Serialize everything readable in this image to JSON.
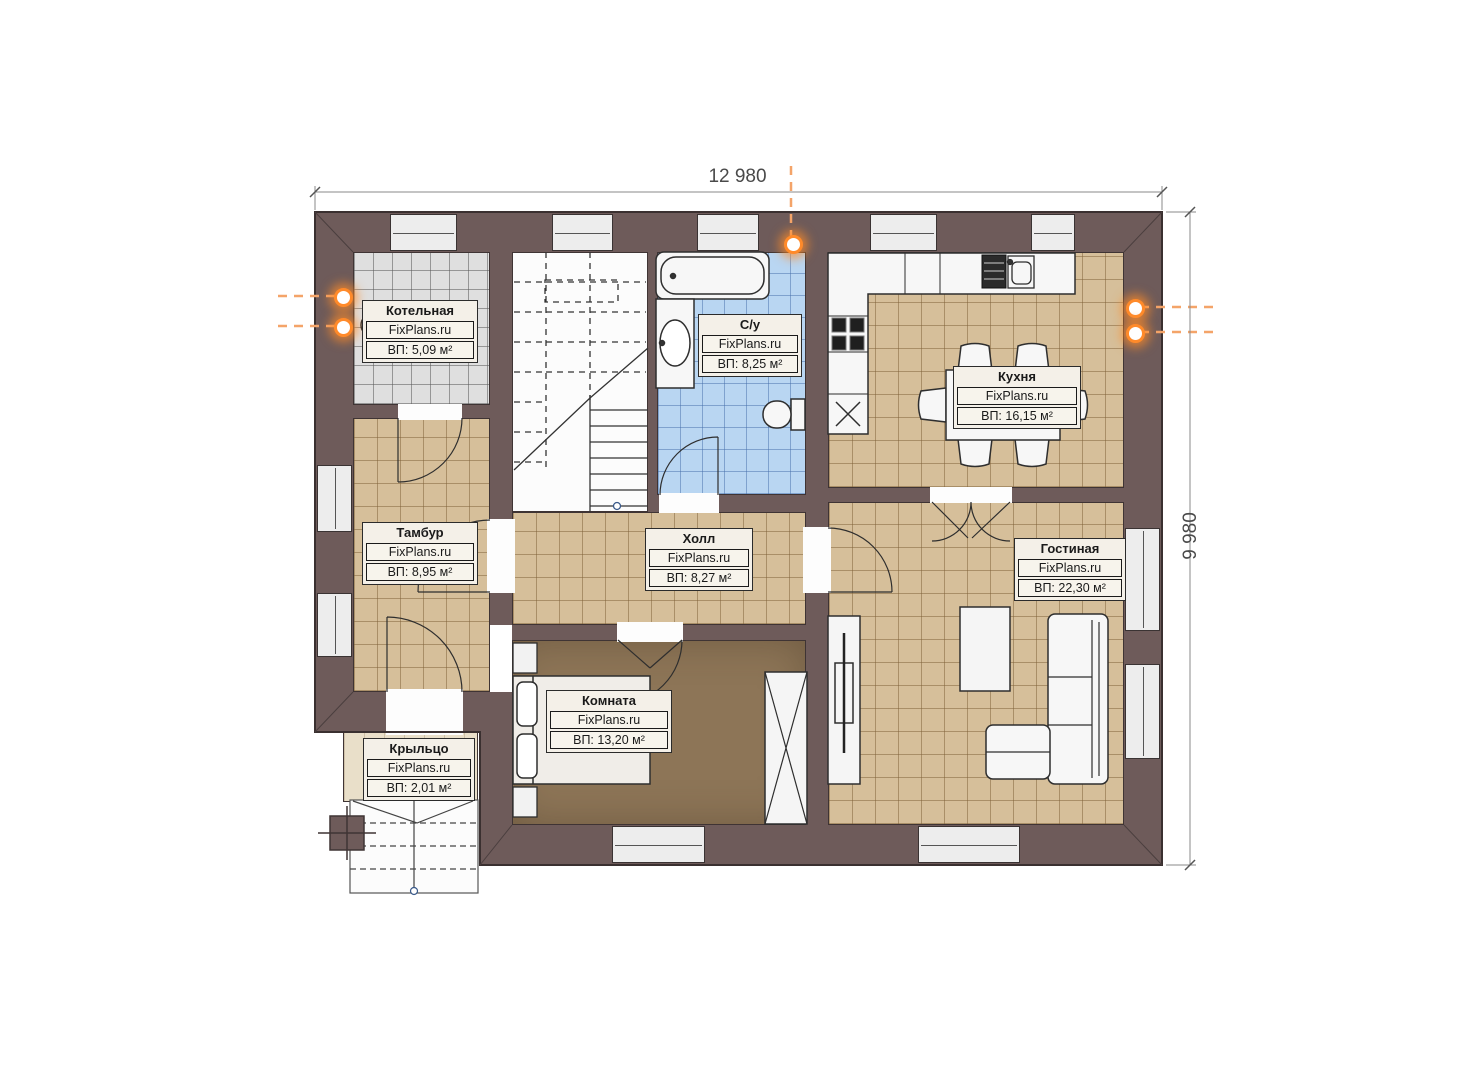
{
  "plan": {
    "dimension_width": "12 980",
    "dimension_height": "9 980"
  },
  "rooms": [
    {
      "id": "kotelnaya",
      "name": "Котельная",
      "brand": "FixPlans.ru",
      "area": "ВП: 5,09 м²"
    },
    {
      "id": "su",
      "name": "С/у",
      "brand": "FixPlans.ru",
      "area": "ВП: 8,25 м²"
    },
    {
      "id": "kuhnya",
      "name": "Кухня",
      "brand": "FixPlans.ru",
      "area": "ВП: 16,15 м²"
    },
    {
      "id": "tambur",
      "name": "Тамбур",
      "brand": "FixPlans.ru",
      "area": "ВП: 8,95 м²"
    },
    {
      "id": "holl",
      "name": "Холл",
      "brand": "FixPlans.ru",
      "area": "ВП: 8,27 м²"
    },
    {
      "id": "gostinaya",
      "name": "Гостиная",
      "brand": "FixPlans.ru",
      "area": "ВП: 22,30 м²"
    },
    {
      "id": "komnata",
      "name": "Комната",
      "brand": "FixPlans.ru",
      "area": "ВП: 13,20 м²"
    },
    {
      "id": "kryltso",
      "name": "Крыльцо",
      "brand": "FixPlans.ru",
      "area": "ВП: 2,01 м²"
    }
  ],
  "colors": {
    "wall": "#6e5b5a",
    "floor_tile_tan": "#d6bf9a",
    "floor_tile_blue": "#b9d6f2",
    "floor_tile_gray": "#dfdfdf",
    "floor_bedroom": "#8d7557",
    "floor_porch": "#e9dfc9",
    "marker_orange": "#ff8a2a"
  }
}
